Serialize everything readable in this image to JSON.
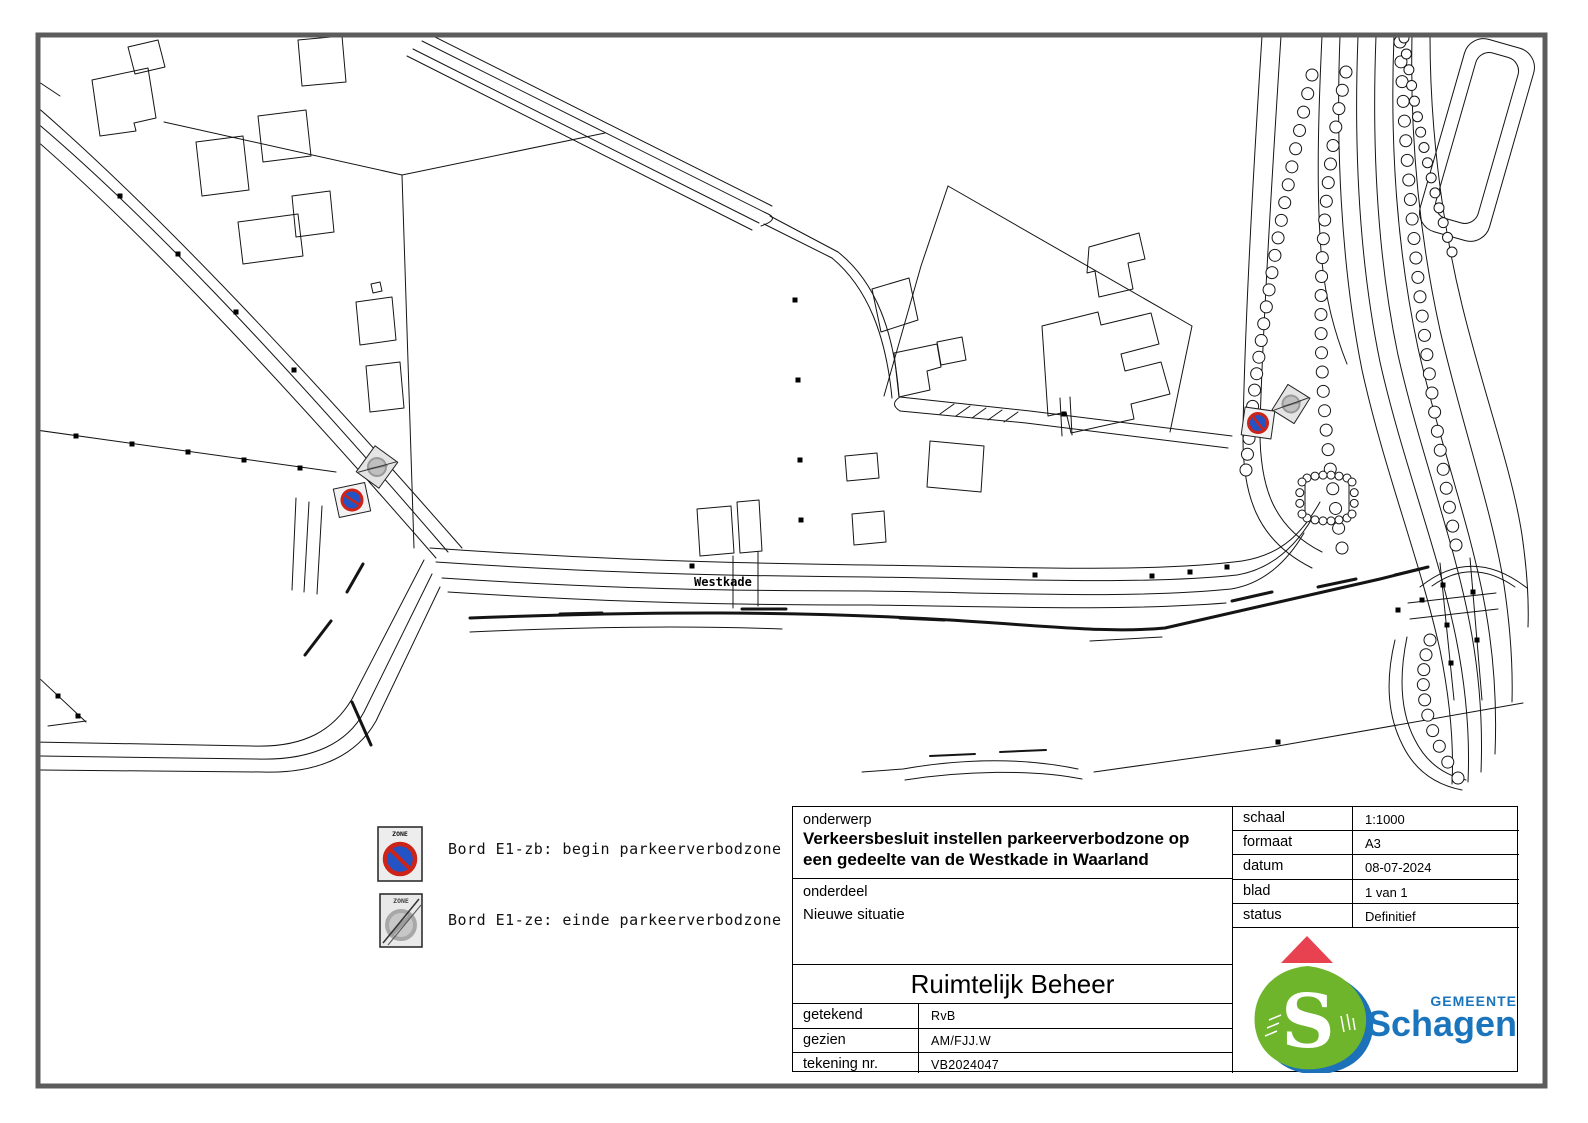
{
  "map": {
    "road_label": "Westkade"
  },
  "legend": {
    "zone_text": "ZONE",
    "items": [
      {
        "id": "E1-zb",
        "label": "Bord E1-zb: begin parkeerverbodzone"
      },
      {
        "id": "E1-ze",
        "label": "Bord E1-ze: einde parkeerverbodzone"
      }
    ]
  },
  "title_block": {
    "onderwerp_label": "onderwerp",
    "onderwerp_value": "Verkeersbesluit instellen parkeerverbodzone op een gedeelte van de Westkade in Waarland",
    "onderdeel_label": "onderdeel",
    "onderdeel_value": "Nieuwe situatie",
    "department": "Ruimtelijk Beheer",
    "rows_left": [
      {
        "label": "getekend",
        "value": "RvB"
      },
      {
        "label": "gezien",
        "value": "AM/FJJ.W"
      },
      {
        "label": "tekening nr.",
        "value": "VB2024047"
      }
    ],
    "rows_right": [
      {
        "label": "schaal",
        "value": "1:1000"
      },
      {
        "label": "formaat",
        "value": "A3"
      },
      {
        "label": "datum",
        "value": "08-07-2024"
      },
      {
        "label": "blad",
        "value": "1 van 1"
      },
      {
        "label": "status",
        "value": "Definitief"
      }
    ]
  },
  "logo": {
    "gemeente": "GEMEENTE",
    "name": "Schagen"
  },
  "colors": {
    "sign_blue": "#2453c6",
    "sign_red": "#cc2418",
    "logo_green": "#6fb52c",
    "logo_blue": "#1b75bc",
    "logo_red": "#e8414f"
  }
}
